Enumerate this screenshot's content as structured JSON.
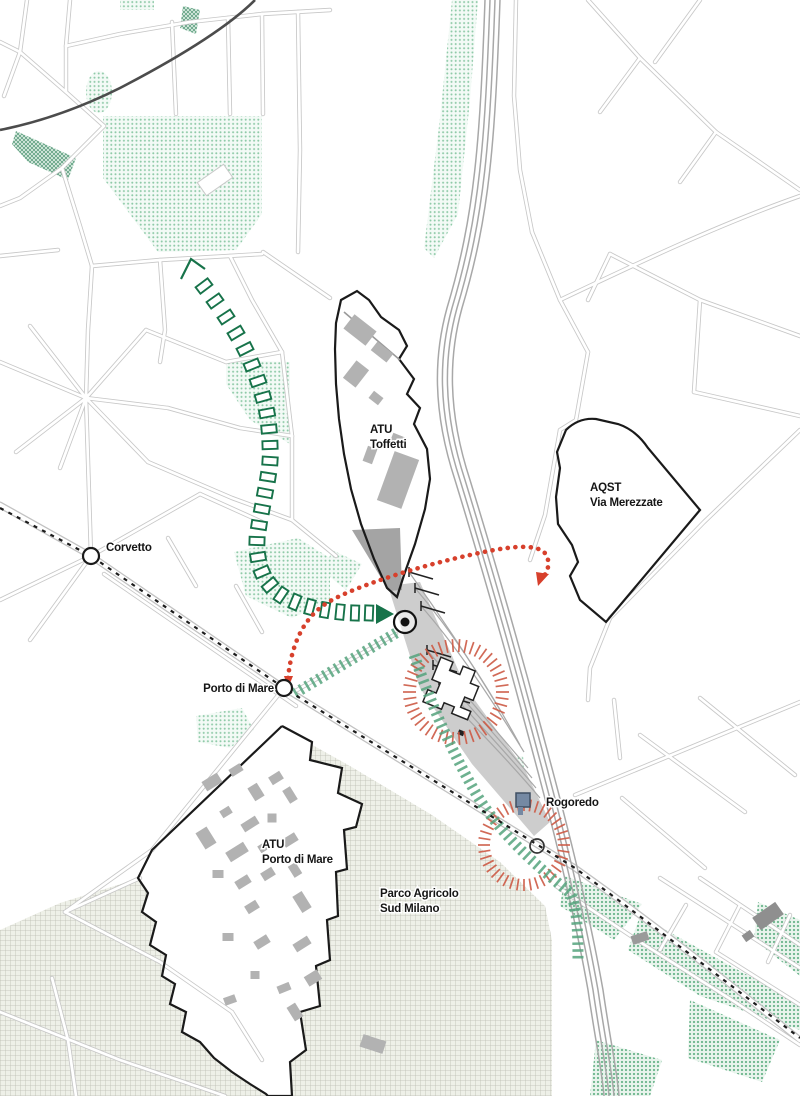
{
  "labels": {
    "corvetto": "Corvetto",
    "atu_toffetti_line1": "ATU",
    "atu_toffetti_line2": "Toffetti",
    "aqst_line1": "AQST",
    "aqst_line2": "Via Merezzate",
    "porto_di_mare": "Porto di Mare",
    "atu_porto_di_mare_line1": "ATU",
    "atu_porto_di_mare_line2": "Porto di Mare",
    "rogoredo": "Rogoredo",
    "parco_line1": "Parco Agricolo",
    "parco_line2": "Sud Milano"
  },
  "colors": {
    "route_red": "#d7402c",
    "focus_ring_red": "#cd5a45",
    "green_ray_dark": "#17734a",
    "green_band": "#55a37d",
    "green_area_dot": "#8fcaa8",
    "boundary_black": "#1a1a1a",
    "station_square_blue": "#7589a3",
    "rail_gray": "#a8a8a8",
    "street_gray": "#c7c7c7",
    "field_hatch": "#bcbdb2",
    "building_gray": "#b2b2b2"
  }
}
